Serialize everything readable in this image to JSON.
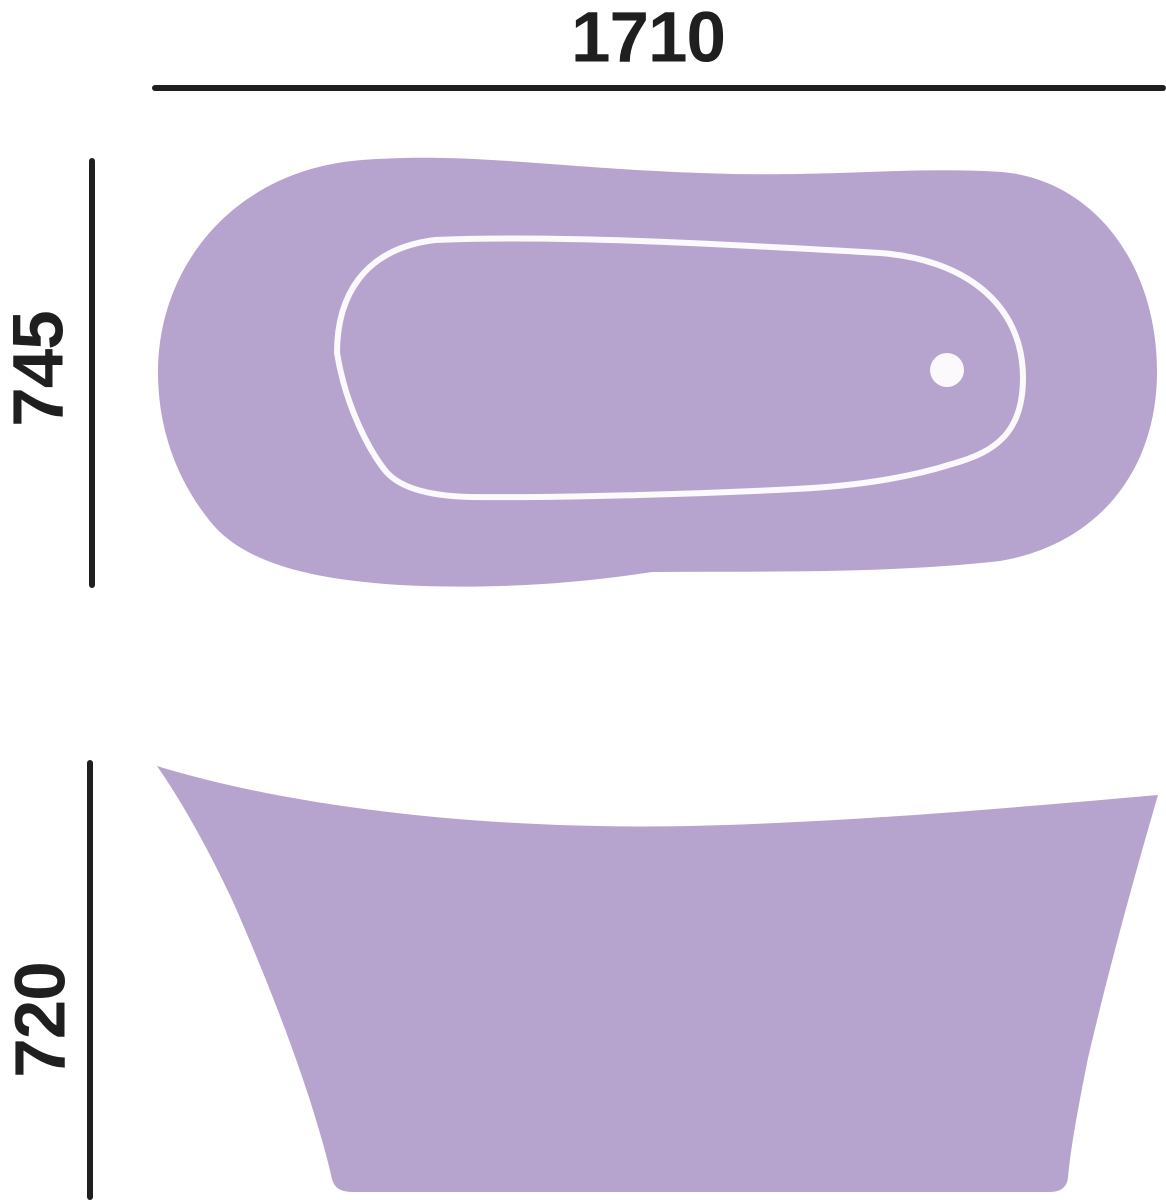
{
  "diagram": {
    "subject": "bathtub",
    "views": [
      "top-view",
      "side-view"
    ]
  },
  "dimensions": {
    "width_label": "1710",
    "depth_label": "745",
    "height_label": "720"
  },
  "colors": {
    "tub_fill": "#b6a4ce",
    "outline_white": "#fbf9fc",
    "dimension_line": "#1f1f1f",
    "text": "#1f1f1f",
    "background": "#ffffff"
  }
}
